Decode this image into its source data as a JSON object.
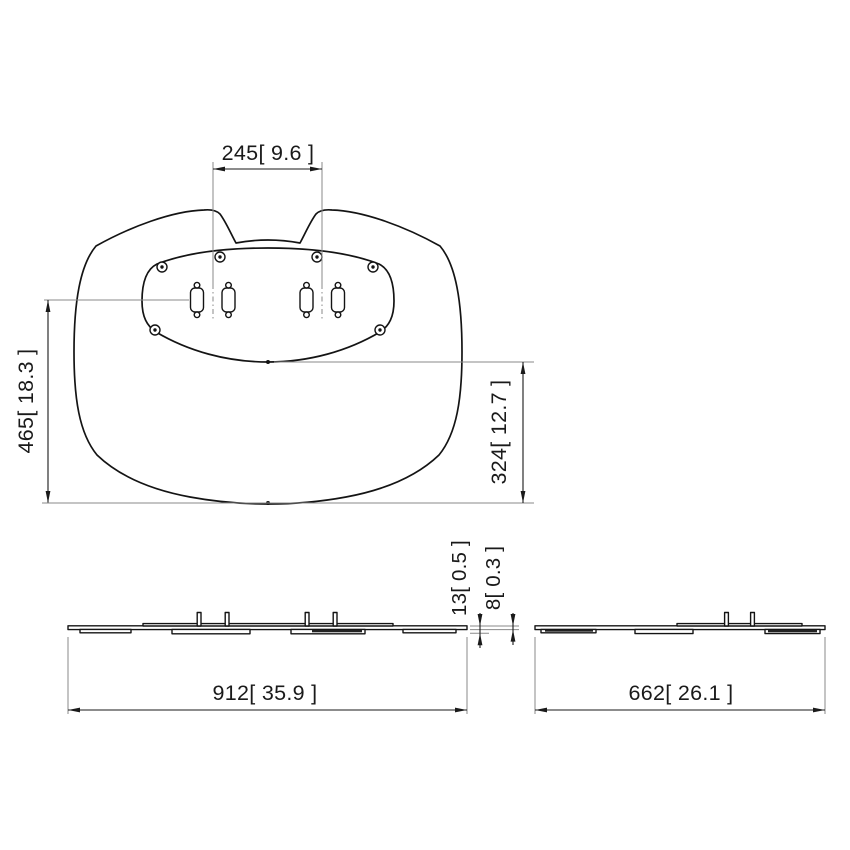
{
  "colors": {
    "background": "#ffffff",
    "line": "#141414",
    "dimension_text": "#1a1a1a",
    "extension_line": "#8a8a8a"
  },
  "top_view": {
    "dim_mount_spacing": "245[ 9.6 ]",
    "dim_depth_total": "465[ 18.3 ]",
    "dim_depth_rear": "324[ 12.7 ]"
  },
  "front_view": {
    "dim_width": "912[ 35.9 ]",
    "dim_height_overall": "13[ 0.5 ]",
    "dim_height_plate": "8[ 0.3 ]"
  },
  "side_view": {
    "dim_width": "662[ 26.1 ]"
  }
}
